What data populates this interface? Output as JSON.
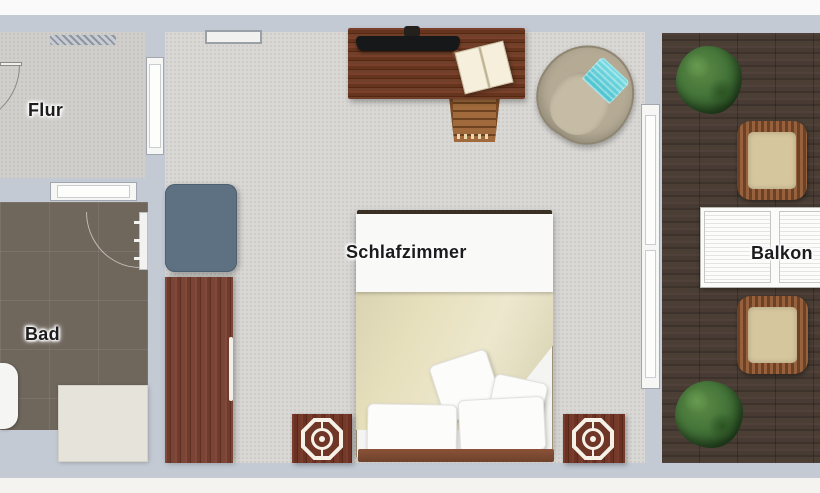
{
  "rooms": [
    {
      "id": "flur",
      "label": "Flur"
    },
    {
      "id": "bad",
      "label": "Bad"
    },
    {
      "id": "schlafzimmer",
      "label": "Schlafzimmer"
    },
    {
      "id": "balkon",
      "label": "Balkon"
    }
  ],
  "furniture": {
    "flur": [
      "radiator",
      "entry-door-swing"
    ],
    "bad": [
      "bathroom-door-swing",
      "toilet",
      "shower-tray"
    ],
    "schlafzimmer": [
      "desk",
      "monitor",
      "open-book",
      "pen",
      "desk-chair",
      "armchair-with-towel",
      "dresser",
      "wardrobe",
      "double-bed",
      "blanket",
      "pillows",
      "headboard",
      "nightstand-left",
      "nightstand-right",
      "table-lamp-left",
      "table-lamp-right"
    ],
    "balkon": [
      "potted-plant-top",
      "potted-plant-bottom",
      "wicker-chair-top",
      "wicker-chair-bottom",
      "slatted-folding-table"
    ]
  },
  "windows_doors": [
    "flur-bedroom-door",
    "flur-bad-door",
    "bedroom-top-window",
    "balcony-door-window"
  ],
  "colors": {
    "wall": "#c4cad4",
    "flur_floor": "#d0cfcb",
    "bad_floor": "#6f665c",
    "bedroom_floor": "#d9d8d5",
    "balcony_deck": "#483b33",
    "wood_furniture": "#73392a",
    "blanket": "#e7e0bd",
    "dresser": "#5d7183",
    "towel_accent": "#62d2da",
    "plant": "#3e6c30",
    "label_text": "#1c1c1e"
  }
}
